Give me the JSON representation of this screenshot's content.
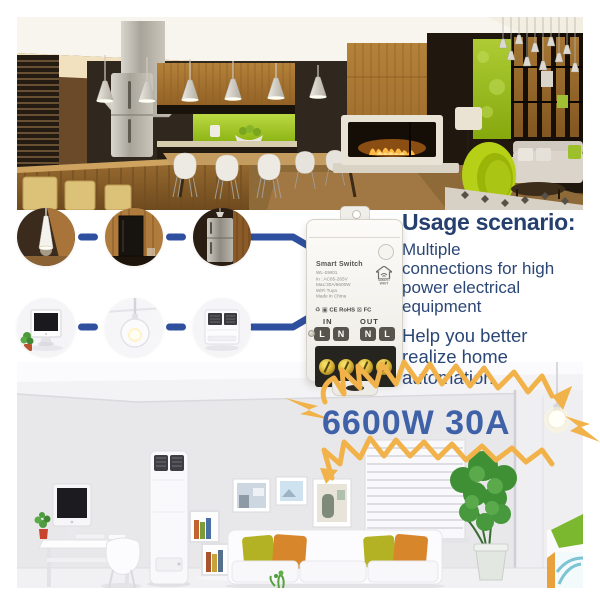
{
  "colors": {
    "accent_blue": "#2f4f9f",
    "navy_text": "#2b4776",
    "power_blue": "#3e61a8",
    "lightning_orange": "#f1b24a"
  },
  "usage": {
    "heading": "Usage scenario:",
    "paragraph1": "Multiple\nconnections for high\npower electrical\nequipment",
    "paragraph2": "Help you better\nrealize home\nautomation"
  },
  "device": {
    "title": "Smart Switch",
    "spec_lines": "WL-SW01\nIn : AC85-265V\nMax:30A/6600W\nWiFi Tuya\nMade in China",
    "brand": "SMART WKIT",
    "certifications": "CE RoHS",
    "fcc_mark": "FC",
    "in_label": "IN",
    "out_label": "OUT",
    "terminals": [
      "L",
      "N",
      "N",
      "L"
    ]
  },
  "power_label": "6600W 30A",
  "appliances": {
    "top_row": [
      "pendant-lamp",
      "television",
      "refrigerator"
    ],
    "bottom_row": [
      "computer",
      "pendant-light",
      "air-conditioner"
    ]
  },
  "cert_icons": {
    "recycle": "♻",
    "box": "▣",
    "weee_bin": "⊠"
  }
}
